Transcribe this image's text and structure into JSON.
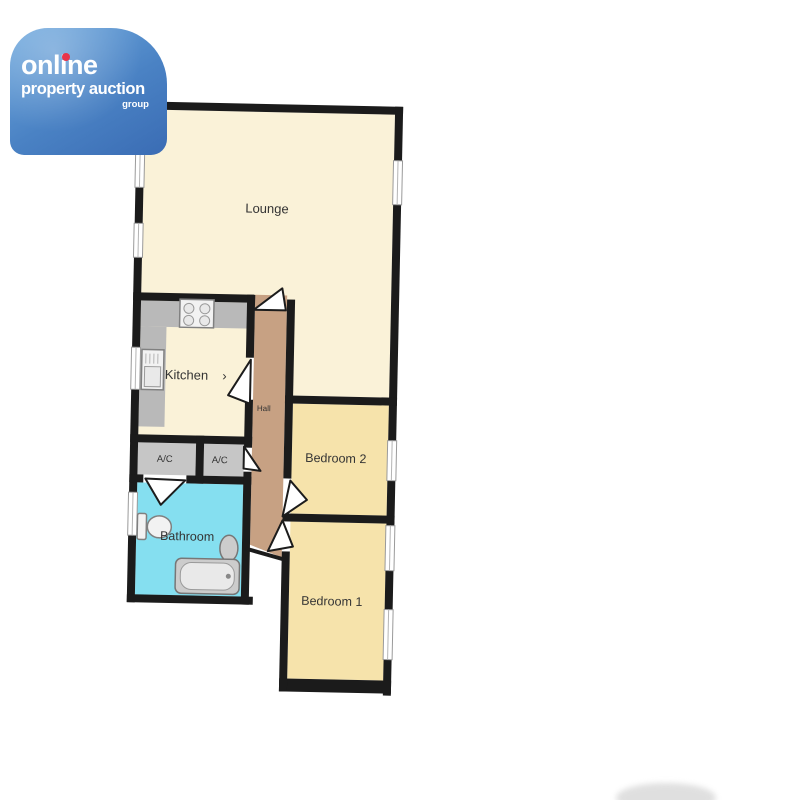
{
  "logo": {
    "brand_line1": "online",
    "brand_line2": "property auction",
    "brand_line3": "group"
  },
  "floorplan": {
    "rooms": {
      "lounge": {
        "label": "Lounge"
      },
      "kitchen": {
        "label": "Kitchen",
        "door_arrow": "›"
      },
      "hall": {
        "label": "Hall"
      },
      "bedroom2": {
        "label": "Bedroom 2"
      },
      "bedroom1": {
        "label": "Bedroom 1"
      },
      "bathroom": {
        "label": "Bathroom"
      },
      "ac_left": {
        "label": "A/C"
      },
      "ac_right": {
        "label": "A/C"
      }
    },
    "colors": {
      "wall": "#1b1b1b",
      "lounge_fill": "#faf2d8",
      "kitchen_fill": "#faf2d8",
      "bedroom_fill": "#f6e3ab",
      "hall_fill": "#c7a183",
      "bathroom_fill": "#85dff0",
      "ac_fill": "#c6c6c6",
      "counter_fill": "#b9b9b9",
      "label": "#333333",
      "logo_blue_light": "#6fa9de",
      "logo_blue_dark": "#3a6cb4",
      "logo_red": "#e8334a"
    }
  }
}
